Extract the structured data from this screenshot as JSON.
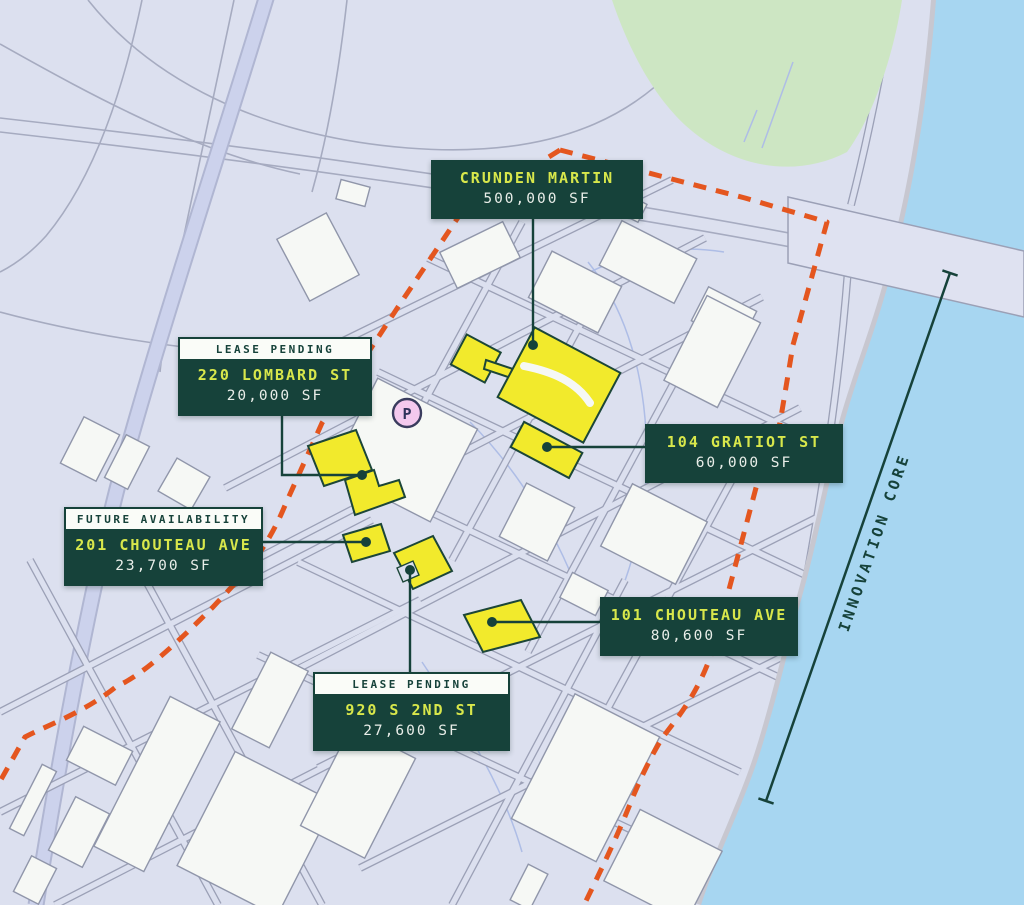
{
  "map": {
    "region_annotation": "INNOVATION CORE",
    "parking_marker": "P",
    "labels": [
      {
        "tag": "",
        "title": "CRUNDEN MARTIN",
        "value": "500,000 SF"
      },
      {
        "tag": "LEASE PENDING",
        "title": "220 LOMBARD ST",
        "value": "20,000 SF"
      },
      {
        "tag": "",
        "title": "104 GRATIOT ST",
        "value": "60,000 SF"
      },
      {
        "tag": "FUTURE AVAILABILITY",
        "title": "201 CHOUTEAU AVE",
        "value": "23,700 SF"
      },
      {
        "tag": "",
        "title": "101 CHOUTEAU AVE",
        "value": "80,600 SF"
      },
      {
        "tag": "LEASE PENDING",
        "title": "920 S 2ND ST",
        "value": "27,600 SF"
      }
    ],
    "colors": {
      "district_boundary": "#E4561F",
      "available_building": "#F2EA2C",
      "label_background": "#16423A",
      "label_title": "#D8E74B",
      "label_value": "#E8EDE8",
      "tag_background": "#FAFCF8",
      "water": "#A7D6F1",
      "park": "#CDE6C3",
      "map_base": "#DCE0EF"
    }
  }
}
